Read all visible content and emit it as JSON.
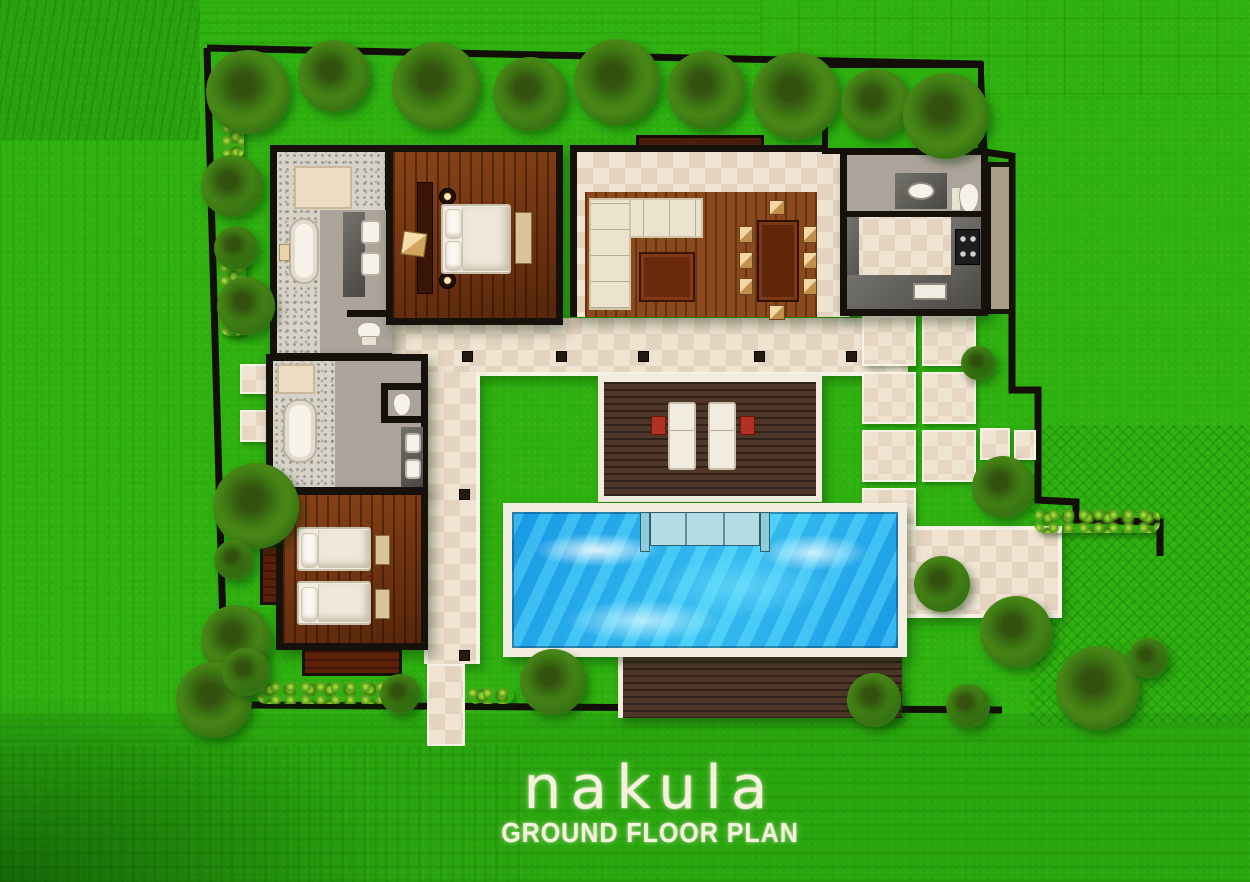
{
  "meta": {
    "kind": "architectural ground floor plan, top-down 3D render",
    "property_name": "nakula"
  },
  "title": {
    "text": "nakula",
    "subtitle": "GROUND FLOOR PLAN"
  },
  "palette": {
    "grass": "#2eb00f",
    "boundary_wall": "#17110b",
    "terrace_tile": "#efe3d2",
    "bedroom_wood": "#70300f",
    "platform_wood": "#8a4a1e",
    "deck_wood": "#4e3729",
    "pool_water": "#23aeef",
    "pool_frame": "#f4eee2",
    "pebble_floor": "#d7d3c9",
    "bathroom_gray": "#aca49a",
    "counter_gray": "#5c5a54",
    "linen_white": "#f2ece0",
    "chair_wood": "#e9c28f",
    "accent_red": "#b23222",
    "foliage_green": "#55981c",
    "title_text": "#f4f1dc"
  },
  "features": [
    "walled garden boundary with tropical trees and hedges",
    "master bedroom with double bed, bedside lamps and bench",
    "master bathroom with pebble floor, bathtub, twin vanity and wc",
    "open living and dining pavilion with sofa, coffee table and dining table for eight",
    "kitchen with u-shaped counter and stove",
    "powder room with wc and basin",
    "guest bathroom with bathtub, twin vanity and wc",
    "twin guest bedroom with two single beds",
    "central lawn courtyard",
    "timber sun deck with two sun loungers",
    "rectangular swimming pool with entry steps",
    "pool-side timber deck",
    "entrance terrace and stepping-stone garden paths"
  ],
  "counts": {
    "bedrooms_visible": 2,
    "bathrooms_visible": 3,
    "sun_loungers": 2,
    "dining_chairs": 8,
    "twin_beds": 2,
    "pools": 1
  }
}
